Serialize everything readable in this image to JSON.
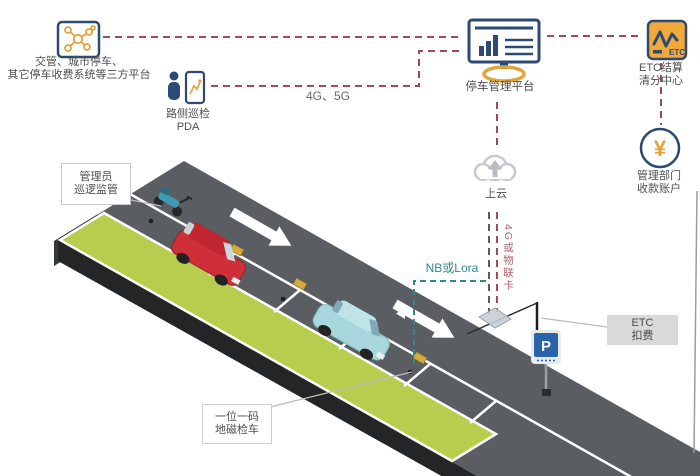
{
  "scene": {
    "third_party": {
      "line1": "交管、城市停车、",
      "line2": "其它停车收费系统等三方平台"
    },
    "pda": {
      "line1": "路侧巡检",
      "line2": "PDA"
    },
    "platform": {
      "label": "停车管理平台"
    },
    "etc_center": {
      "line1": "ETC结算",
      "line2": "清分中心",
      "icon_text": "ETC"
    },
    "account": {
      "line1": "管理部门",
      "line2": "收款账户",
      "symbol": "¥"
    },
    "cloud": {
      "label": "上云"
    },
    "links": {
      "g45": "4G、5G",
      "nb_lora": "NB或Lora",
      "iot": "4G或物联卡"
    },
    "admin_box": {
      "line1": "管理员",
      "line2": "巡逻监管"
    },
    "one_code_box": {
      "line1": "一位一码",
      "line2": "地磁检车"
    },
    "etc_fee_box": {
      "line1": "ETC",
      "line2": "扣费"
    },
    "p_sign": "P",
    "colors": {
      "dash_red": "#9c4e54",
      "teal": "#2e8a8c",
      "navy": "#2d4a73",
      "orange": "#e2a43c",
      "road": "#5a5e62",
      "green_strip": "#b7cd4d",
      "iot_red": "#b06066",
      "sign_blue": "#2b63a8"
    }
  }
}
